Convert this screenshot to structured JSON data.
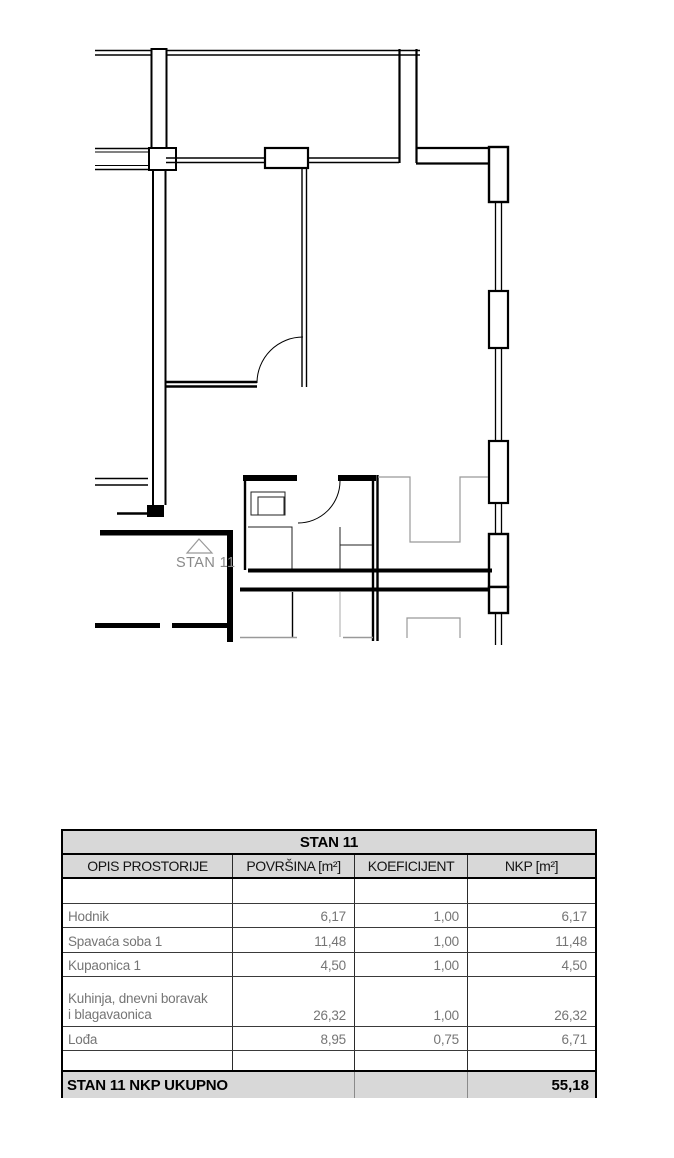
{
  "plan": {
    "label": "STAN 11",
    "label_color": "#8a8a8a",
    "wall_color": "#000000",
    "furniture_color": "#999999"
  },
  "table": {
    "title": "STAN 11",
    "columns": [
      "OPIS PROSTORIJE",
      "POVRŠINA [m²]",
      "KOEFICIJENT",
      "NKP [m²]"
    ],
    "rows": [
      {
        "name": "Hodnik",
        "povrsina": "6,17",
        "koeficijent": "1,00",
        "nkp": "6,17"
      },
      {
        "name": "Spavaća soba 1",
        "povrsina": "11,48",
        "koeficijent": "1,00",
        "nkp": "11,48"
      },
      {
        "name": "Kupaonica 1",
        "povrsina": "4,50",
        "koeficijent": "1,00",
        "nkp": "4,50"
      },
      {
        "name_lines": [
          "Kuhinja, dnevni boravak",
          "i blagavaonica"
        ],
        "povrsina": "26,32",
        "koeficijent": "1,00",
        "nkp": "26,32"
      },
      {
        "name": "Lođa",
        "povrsina": "8,95",
        "koeficijent": "0,75",
        "nkp": "6,71"
      }
    ],
    "total_label": "STAN 11 NKP UKUPNO",
    "total_value": "55,18",
    "header_bg": "#d8d8d8",
    "data_text_color": "#757575"
  }
}
